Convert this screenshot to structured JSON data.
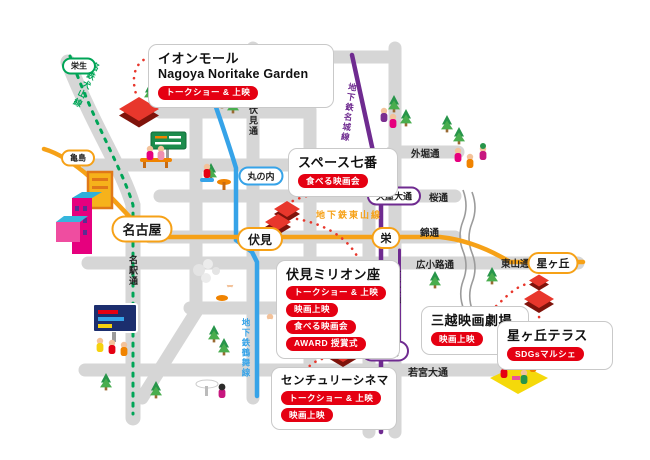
{
  "map": {
    "venues": [
      {
        "id": "aeon-mall",
        "title": "イオンモール",
        "subtitle": "Nagoya Noritake Garden",
        "tags": [
          "トークショー & 上映"
        ]
      },
      {
        "id": "space-nanaban",
        "title": "スペース七番",
        "tags": [
          "食べる映画会"
        ]
      },
      {
        "id": "fushimi-million-za",
        "title": "伏見ミリオン座",
        "tags": [
          "トークショー & 上映",
          "映画上映",
          "食べる映画会",
          "AWARD 授賞式"
        ]
      },
      {
        "id": "mitsukoshi-eiga-gekijo",
        "title": "三越映画劇場",
        "tags": [
          "映画上映"
        ]
      },
      {
        "id": "hoshigaoka-terrace",
        "title": "星ヶ丘テラス",
        "tags": [
          "SDGsマルシェ"
        ]
      },
      {
        "id": "century-cinema",
        "title": "センチュリーシネマ",
        "tags": [
          "トークショー & 上映",
          "映画上映"
        ]
      }
    ],
    "stations": [
      {
        "name": "栄生",
        "line_color": "#00a557"
      },
      {
        "name": "亀島",
        "line_color": "#f6a117"
      },
      {
        "name": "名古屋",
        "line_color": "#f6a117"
      },
      {
        "name": "丸の内",
        "line_color": "#36a3e8"
      },
      {
        "name": "伏見",
        "line_color": "#f6a117"
      },
      {
        "name": "栄",
        "line_color": "#f6a117"
      },
      {
        "name": "久屋大通",
        "line_color": "#6f2b90"
      },
      {
        "name": "矢場町",
        "line_color": "#6f2b90"
      },
      {
        "name": "星ヶ丘",
        "line_color": "#f6a117"
      }
    ],
    "roads": [
      {
        "name": "伏見通"
      },
      {
        "name": "名駅通"
      },
      {
        "name": "外堀通"
      },
      {
        "name": "桜通"
      },
      {
        "name": "錦通"
      },
      {
        "name": "広小路通"
      },
      {
        "name": "東山通"
      },
      {
        "name": "大津通"
      },
      {
        "name": "久屋大通"
      },
      {
        "name": "若宮大通"
      }
    ],
    "lines": [
      {
        "name": "名鉄犬山線",
        "color": "#00a557"
      },
      {
        "name": "地下鉄鶴舞線",
        "color": "#36a3e8"
      },
      {
        "name": "地下鉄東山線",
        "color": "#f6a117"
      },
      {
        "name": "地下鉄名城線",
        "color": "#6f2b90"
      }
    ],
    "colors": {
      "road_gray": "#d6d6d6",
      "tag_red": "#e50012",
      "marker_red": "#e8372c",
      "line_orange": "#f6a117",
      "line_blue": "#36a3e8",
      "line_purple": "#6f2b90",
      "line_green": "#00a557"
    }
  }
}
